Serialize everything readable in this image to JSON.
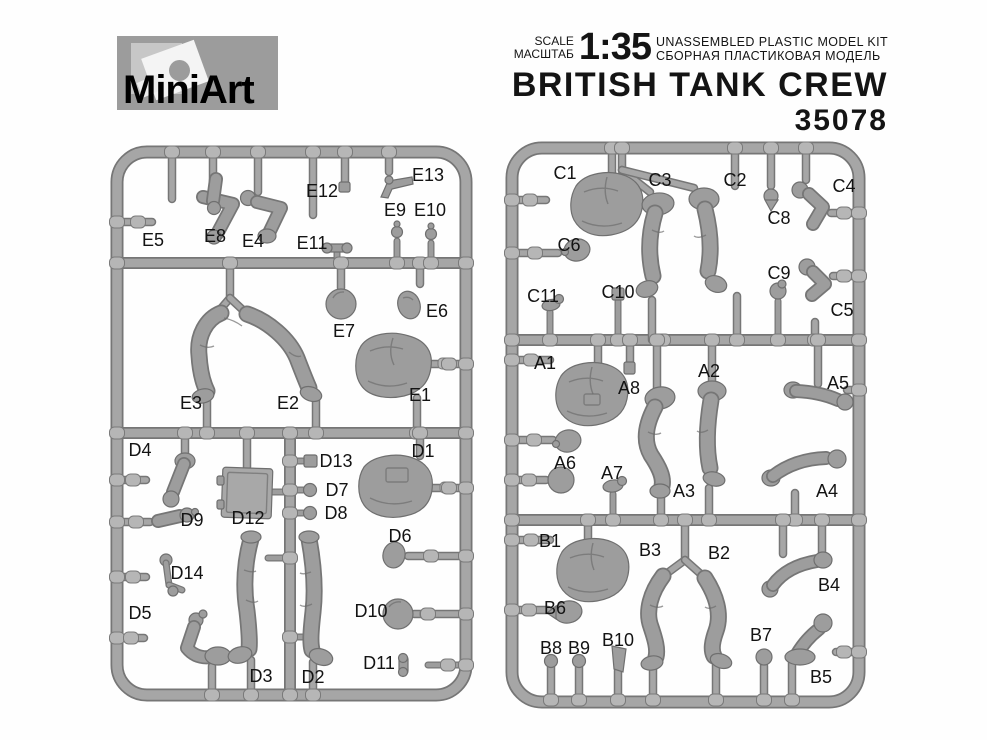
{
  "header": {
    "brand": "MiniArt",
    "scale_label_en": "SCALE",
    "scale_label_ru": "МАСШТАБ",
    "scale_value": "1:35",
    "kit_type_en": "UNASSEMBLED PLASTIC MODEL KIT",
    "kit_type_ru": "СБОРНАЯ ПЛАСТИКОВАЯ МОДЕЛЬ",
    "title": "BRITISH TANK CREW",
    "kit_number": "35078"
  },
  "colors": {
    "sprue": "#a6a6a6",
    "sprue_edge": "#767676",
    "part": "#9d9d9d",
    "label_text": "#131313",
    "logo_bg": "#9c9c9c"
  },
  "sprues": [
    {
      "id": "left",
      "labels": [
        {
          "text": "E5",
          "x": 153,
          "y": 240
        },
        {
          "text": "E8",
          "x": 215,
          "y": 236
        },
        {
          "text": "E4",
          "x": 253,
          "y": 241
        },
        {
          "text": "E12",
          "x": 322,
          "y": 191
        },
        {
          "text": "E13",
          "x": 428,
          "y": 175
        },
        {
          "text": "E11",
          "x": 312,
          "y": 243
        },
        {
          "text": "E9",
          "x": 395,
          "y": 210
        },
        {
          "text": "E10",
          "x": 430,
          "y": 210
        },
        {
          "text": "E7",
          "x": 344,
          "y": 331
        },
        {
          "text": "E6",
          "x": 437,
          "y": 311
        },
        {
          "text": "E3",
          "x": 191,
          "y": 403
        },
        {
          "text": "E2",
          "x": 288,
          "y": 403
        },
        {
          "text": "E1",
          "x": 420,
          "y": 395
        },
        {
          "text": "D4",
          "x": 140,
          "y": 450
        },
        {
          "text": "D13",
          "x": 336,
          "y": 461
        },
        {
          "text": "D1",
          "x": 423,
          "y": 451
        },
        {
          "text": "D12",
          "x": 248,
          "y": 518
        },
        {
          "text": "D7",
          "x": 337,
          "y": 490
        },
        {
          "text": "D8",
          "x": 336,
          "y": 513
        },
        {
          "text": "D9",
          "x": 192,
          "y": 520
        },
        {
          "text": "D6",
          "x": 400,
          "y": 536
        },
        {
          "text": "D14",
          "x": 187,
          "y": 573
        },
        {
          "text": "D5",
          "x": 140,
          "y": 613
        },
        {
          "text": "D10",
          "x": 371,
          "y": 611
        },
        {
          "text": "D11",
          "x": 379,
          "y": 663
        },
        {
          "text": "D3",
          "x": 261,
          "y": 676
        },
        {
          "text": "D2",
          "x": 313,
          "y": 677
        }
      ]
    },
    {
      "id": "right",
      "labels": [
        {
          "text": "C1",
          "x": 565,
          "y": 173
        },
        {
          "text": "C3",
          "x": 660,
          "y": 180
        },
        {
          "text": "C2",
          "x": 735,
          "y": 180
        },
        {
          "text": "C4",
          "x": 844,
          "y": 186
        },
        {
          "text": "C8",
          "x": 779,
          "y": 218
        },
        {
          "text": "C6",
          "x": 569,
          "y": 245
        },
        {
          "text": "C9",
          "x": 779,
          "y": 273
        },
        {
          "text": "C5",
          "x": 842,
          "y": 310
        },
        {
          "text": "C11",
          "x": 543,
          "y": 296
        },
        {
          "text": "C10",
          "x": 618,
          "y": 292
        },
        {
          "text": "A1",
          "x": 545,
          "y": 363
        },
        {
          "text": "A8",
          "x": 629,
          "y": 388
        },
        {
          "text": "A2",
          "x": 709,
          "y": 371
        },
        {
          "text": "A5",
          "x": 838,
          "y": 383
        },
        {
          "text": "A6",
          "x": 565,
          "y": 463
        },
        {
          "text": "A7",
          "x": 612,
          "y": 473
        },
        {
          "text": "A3",
          "x": 684,
          "y": 491
        },
        {
          "text": "A4",
          "x": 827,
          "y": 491
        },
        {
          "text": "B1",
          "x": 550,
          "y": 541
        },
        {
          "text": "B3",
          "x": 650,
          "y": 550
        },
        {
          "text": "B2",
          "x": 719,
          "y": 553
        },
        {
          "text": "B4",
          "x": 829,
          "y": 585
        },
        {
          "text": "B6",
          "x": 555,
          "y": 608
        },
        {
          "text": "B10",
          "x": 618,
          "y": 640
        },
        {
          "text": "B7",
          "x": 761,
          "y": 635
        },
        {
          "text": "B8",
          "x": 551,
          "y": 648
        },
        {
          "text": "B9",
          "x": 579,
          "y": 648
        },
        {
          "text": "B5",
          "x": 821,
          "y": 677
        }
      ]
    }
  ]
}
